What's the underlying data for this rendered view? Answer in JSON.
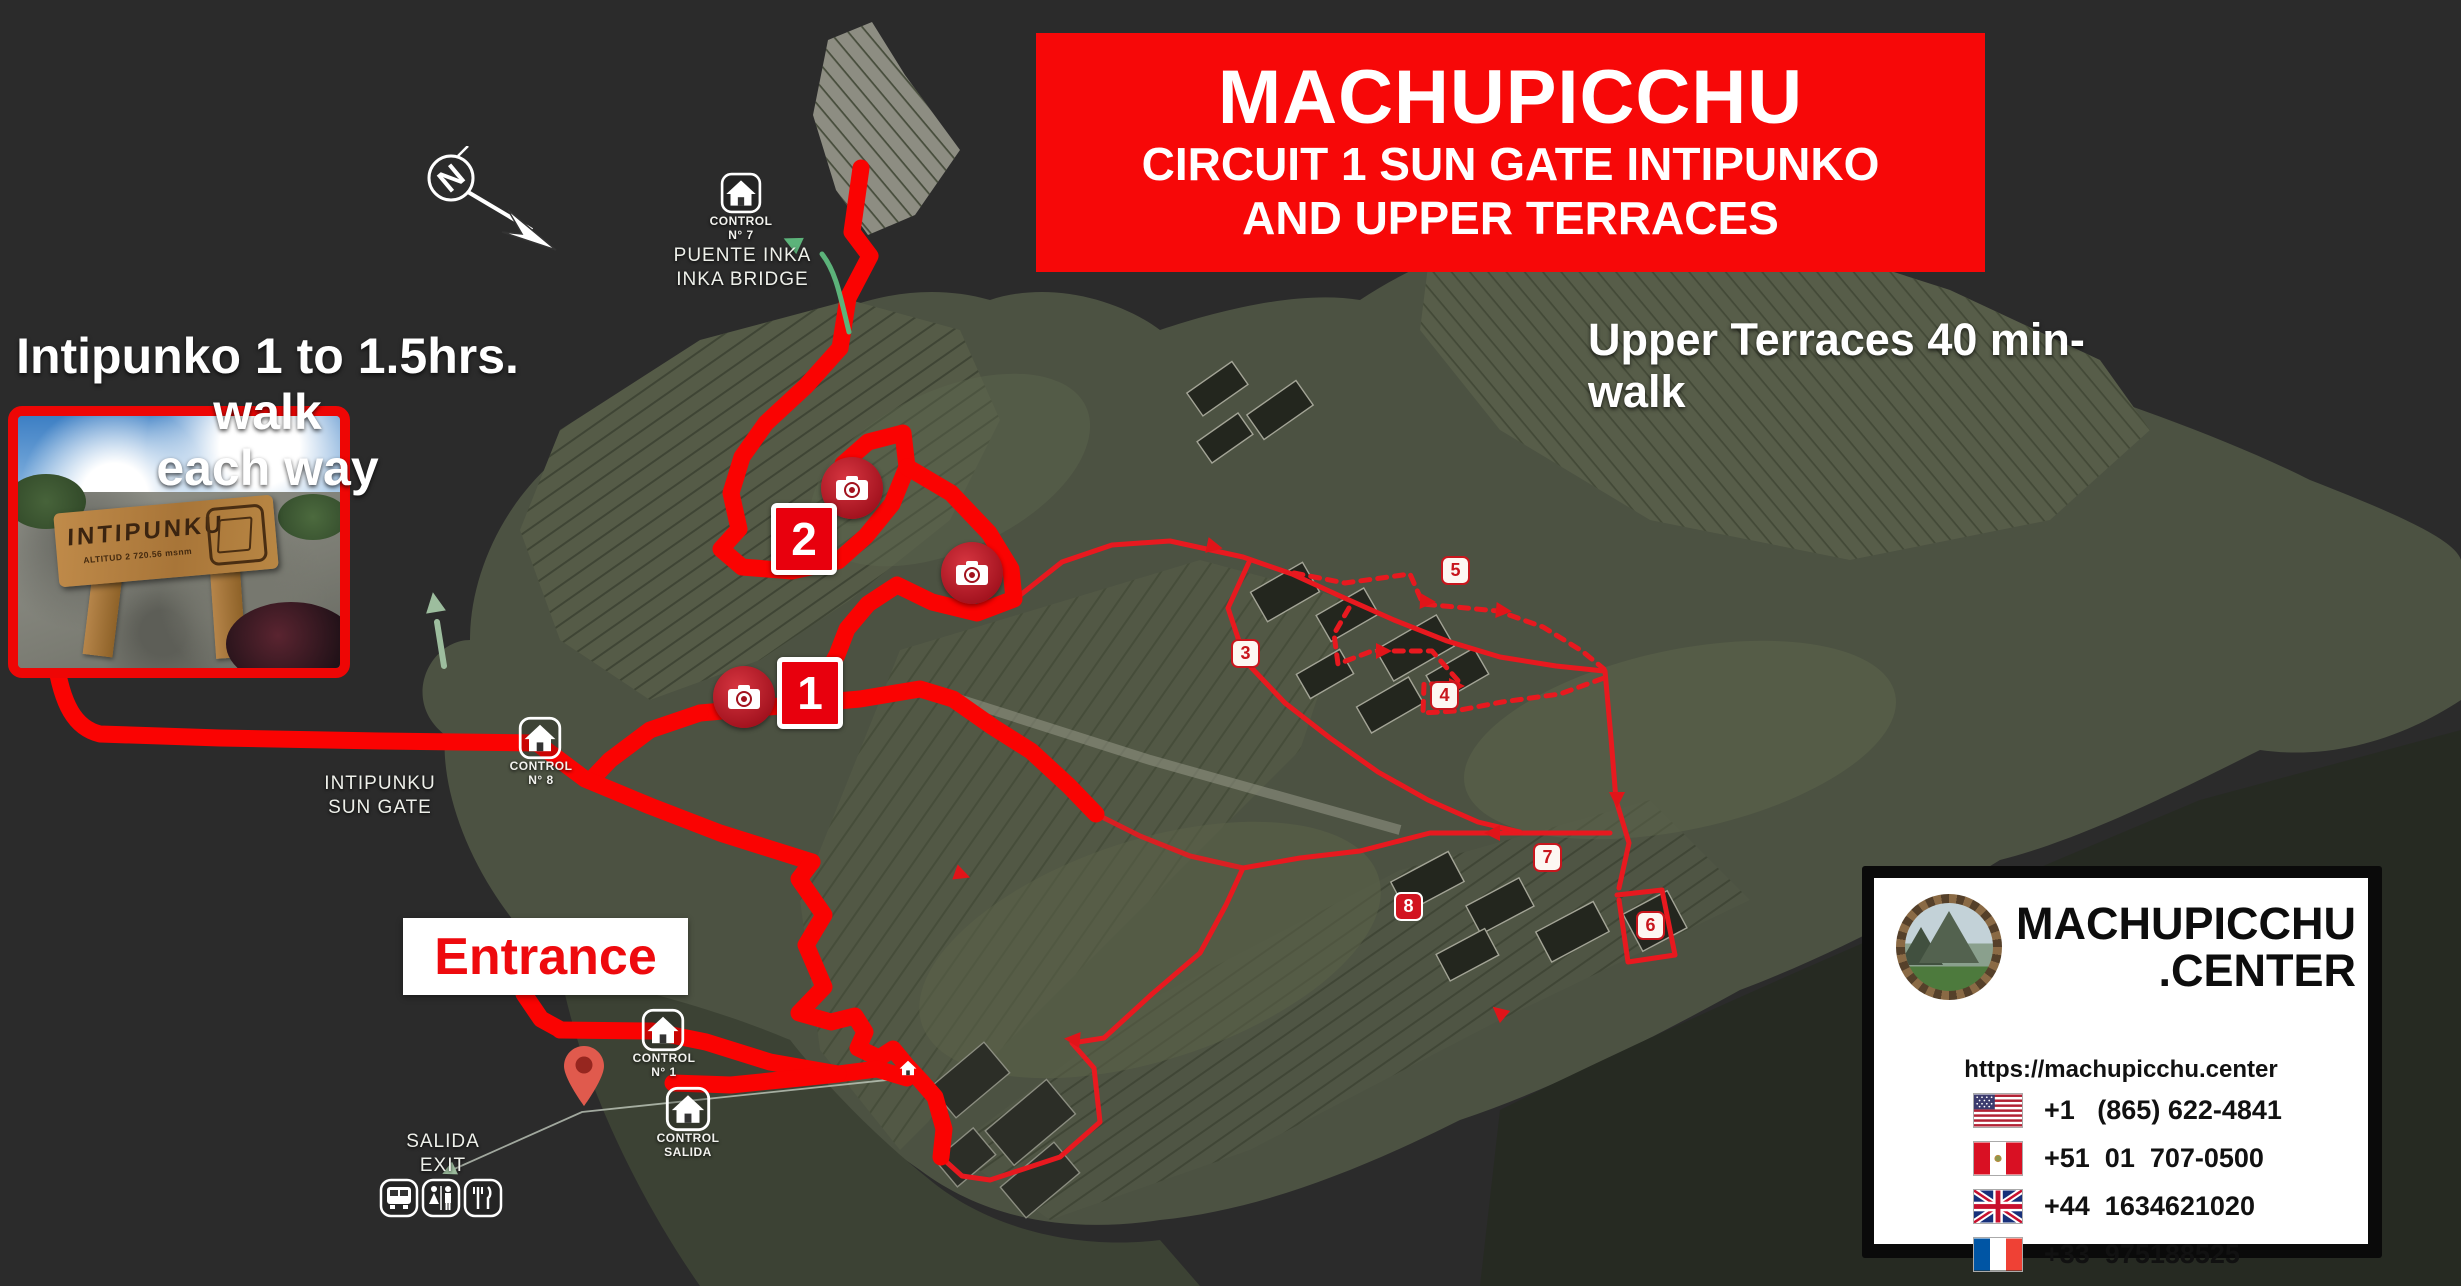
{
  "banner": {
    "title": "MACHUPICCHU",
    "subtitle1": "CIRCUIT 1 SUN GATE INTIPUNKO",
    "subtitle2": "AND UPPER TERRACES"
  },
  "notes": {
    "intipunko_line1": "Intipunko 1 to 1.5hrs. walk",
    "intipunko_line2": "each way",
    "upper_terraces": "Upper Terraces 40 min-walk",
    "entrance": "Entrance"
  },
  "photo_inset": {
    "sign_title": "INTIPUNKU",
    "sign_subtitle": "ALTITUD   2 720.56 msnm"
  },
  "compass": {
    "letter": "N"
  },
  "stations": {
    "bridge": {
      "control_line1": "CONTROL",
      "control_line2": "N° 7",
      "name_line1": "PUENTE INKA",
      "name_line2": "INKA BRIDGE"
    },
    "sungate": {
      "control_line1": "CONTROL",
      "control_line2": "N° 8",
      "name_line1": "INTIPUNKU",
      "name_line2": "SUN GATE"
    },
    "entrance": {
      "control_line1": "CONTROL",
      "control_line2": "N° 1"
    },
    "exit": {
      "control_line1": "CONTROL",
      "control_line2": "SALIDA",
      "name_line1": "SALIDA",
      "name_line2": "EXIT"
    }
  },
  "route_markers": {
    "large": [
      "1",
      "2"
    ],
    "small": [
      "3",
      "4",
      "5",
      "6",
      "7",
      "8"
    ]
  },
  "brand_card": {
    "name_line1": "MACHUPICCHU",
    "name_line2": ".CENTER",
    "website": "https://machupicchu.center",
    "phones": [
      {
        "country": "USA",
        "number": "+1   (865) 622-4841"
      },
      {
        "country": "Peru",
        "number": "+51  01  707-0500"
      },
      {
        "country": "United Kingdom",
        "number": "+44  1634621020"
      },
      {
        "country": "France",
        "number": "+33  975188525"
      }
    ]
  },
  "colors": {
    "banner_red": "#f70808",
    "route_red": "#fa0302",
    "thin_route_red": "#e8191f",
    "marker_red": "#c8161d",
    "map_green": "#4c5242",
    "background": "#2b2b2b"
  }
}
